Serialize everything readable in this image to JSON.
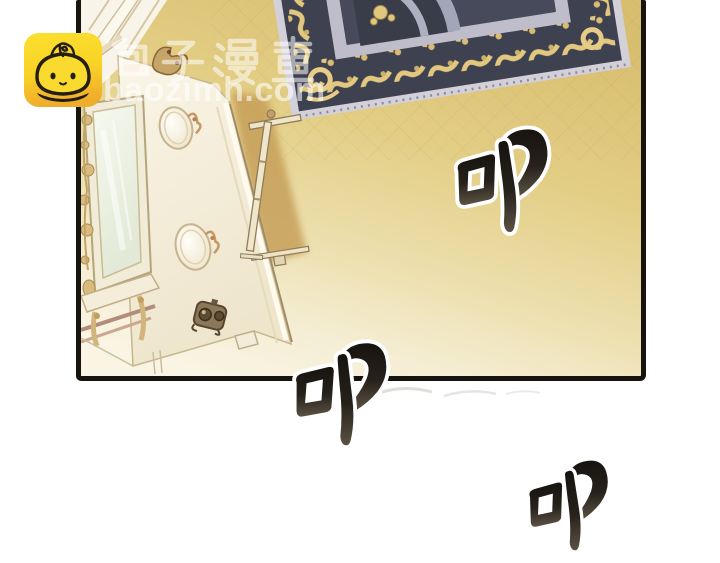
{
  "page": {
    "background_color": "#FFFFFF",
    "kind": "comic-reader-page"
  },
  "panel": {
    "border_color": "#17130E",
    "wall_gold": "#D8BE6F",
    "wall_cream": "#F7F1DD",
    "carpet": {
      "field_navy": "#3E414F",
      "scroll_gold": "#E2C87F",
      "band_gray": "#BFBDC9",
      "fringe_gray": "#D3D0DA"
    },
    "door_cream": "#F7F1E1",
    "door_handle_bronze": "#6F5C41",
    "mirror_glass": "#F0F4E6",
    "gilt_gold": "#D8BB7D",
    "shadow_tan": "#C49C55"
  },
  "watermark": {
    "site_name": "包子漫畫",
    "domain": "baozimh.com",
    "logo_icon": "baozi-bun-mascot-icon",
    "logo_yellow": "#F8D326",
    "text_color": "rgba(255,255,255,0.55)"
  },
  "sfx": [
    {
      "char": "叩"
    },
    {
      "char": "叩"
    },
    {
      "char": "叩"
    }
  ]
}
